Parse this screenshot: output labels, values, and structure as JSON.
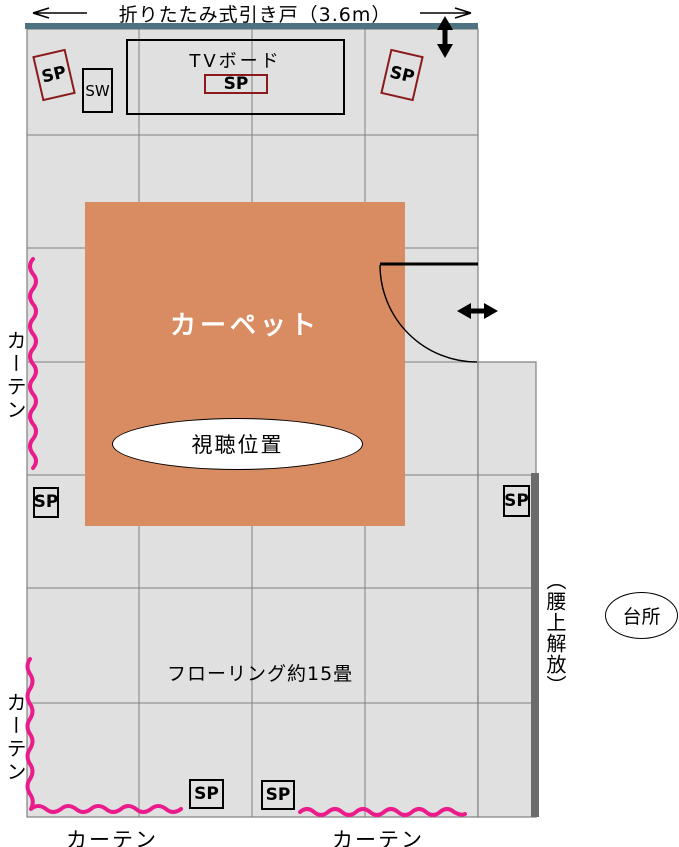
{
  "colors": {
    "room_fill": "#E0E0E0",
    "grid_line": "#808080",
    "carpet": "#D98C62",
    "curtain_pink": "#EA1C8C",
    "door_track_teal": "#4E7282",
    "open_wall_gray": "#6B6B6B",
    "speaker_red": "#8B1A1A"
  },
  "header": {
    "title": "折りたたみ式引き戸（3.6m）"
  },
  "labels": {
    "tv_board": "TVボード",
    "speaker": "SP",
    "subwoofer": "SW",
    "carpet": "カーペット",
    "viewing_position": "視聴位置",
    "curtain": "カーテン",
    "flooring": "フローリング約15畳",
    "waist_open": "（腰上解放）",
    "kitchen": "台所"
  }
}
